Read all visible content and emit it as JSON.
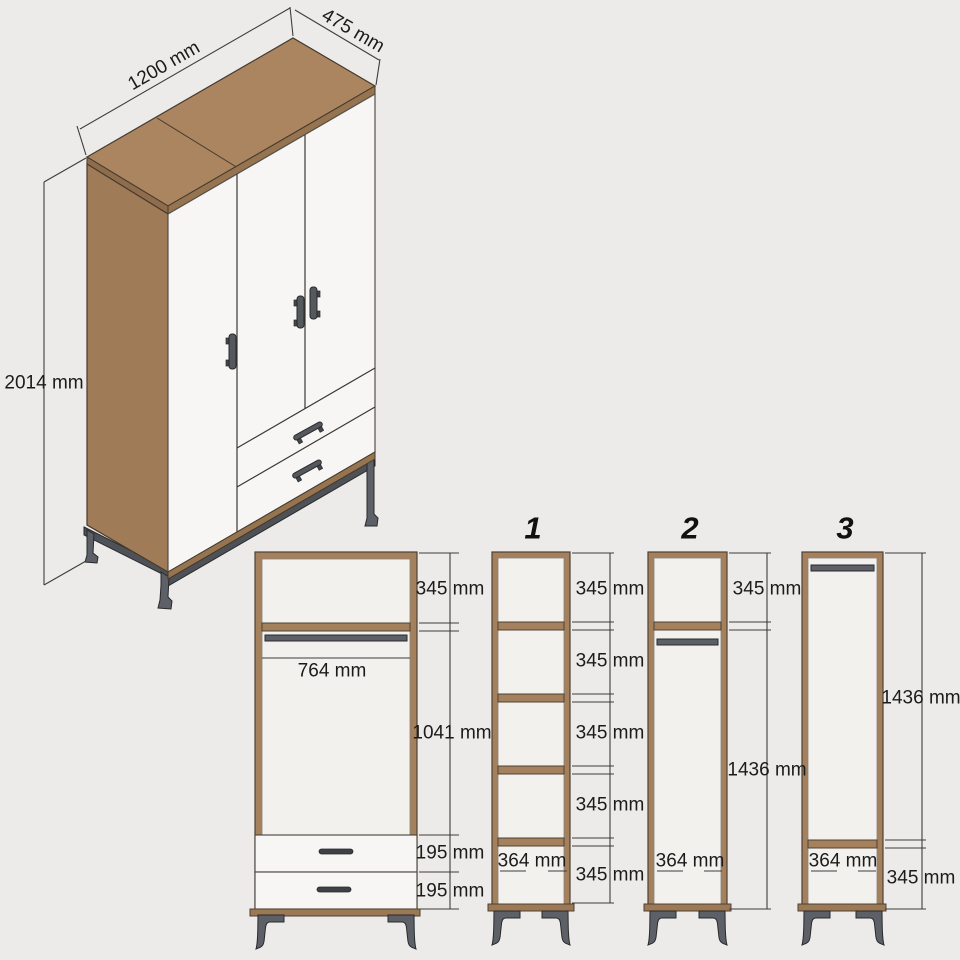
{
  "iso_view": {
    "width_label": "1200 mm",
    "depth_label": "475 mm",
    "height_label": "2014 mm"
  },
  "front_view": {
    "top_section": "345 mm",
    "hanging_width": "764 mm",
    "middle_section": "1041 mm",
    "drawer_top": "195 mm",
    "drawer_bottom": "195 mm"
  },
  "sections": [
    {
      "id": "1",
      "right_dims": [
        "345 mm",
        "345 mm",
        "345 mm",
        "345 mm",
        "345 mm"
      ],
      "inner_width": "364 mm"
    },
    {
      "id": "2",
      "right_dims": [
        "345 mm",
        "1436 mm"
      ],
      "inner_width": "364 mm"
    },
    {
      "id": "3",
      "right_dims": [
        "1436 mm",
        "345 mm"
      ],
      "inner_width": "364 mm"
    }
  ],
  "colors": {
    "background": "#edebe9",
    "wood": "#a8825e",
    "wood_dark": "#96744f",
    "panel_white": "#f7f6f4",
    "interior": "#f2f1ee",
    "metal": "#5d6066",
    "dimension_line": "#3d3d3d",
    "text": "#1b1b1b"
  }
}
